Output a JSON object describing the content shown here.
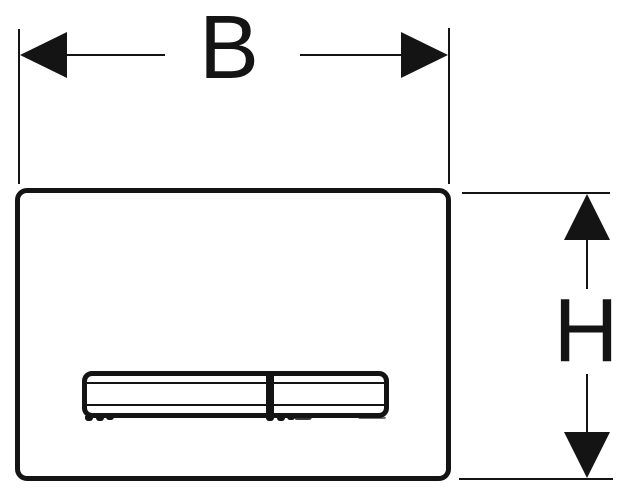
{
  "drawing": {
    "kind": "product-dimension-drawing",
    "subject": "flush-plate-front-view",
    "labels": {
      "width": "B",
      "height": "H"
    },
    "colors": {
      "line": "#141414",
      "background": "#ffffff"
    }
  }
}
